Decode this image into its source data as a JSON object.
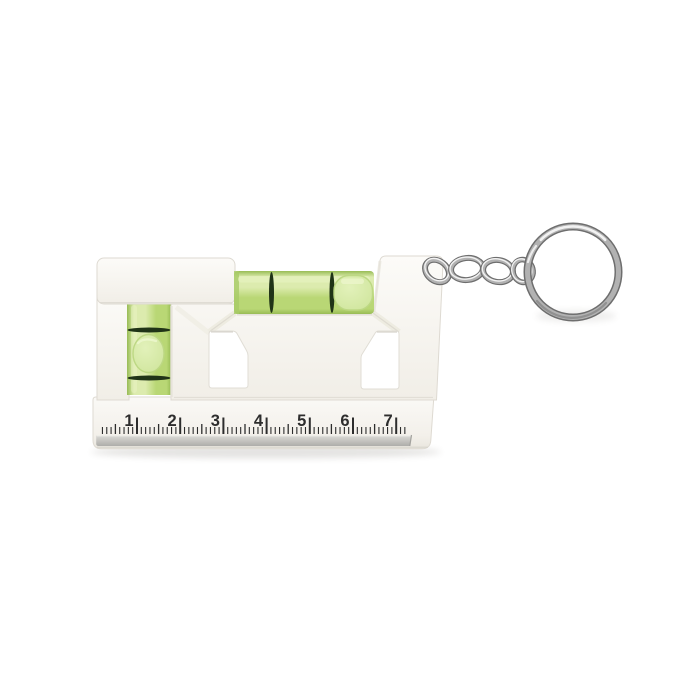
{
  "ruler": {
    "numbers": [
      "1",
      "2",
      "3",
      "4",
      "5",
      "6",
      "7"
    ],
    "minor_ticks_per_unit": 10
  },
  "colors": {
    "background": "#ffffff",
    "body": "#f7f5f0",
    "body_shade": "#e3e0d8",
    "body_edge": "#dedad2",
    "vial_green": "#b9d775",
    "vial_green_light": "#dcebae",
    "vial_green_dark": "#98bc55",
    "vial_ring": "#203417",
    "bubble": "#e2f1ba",
    "ruler_mark": "#2d2d2d",
    "metal_strip": "#c6c5c1",
    "metal_strip_light": "#dddcd8",
    "metal_strip_dark": "#aeadaa",
    "chain_dark": "#6e6e6e",
    "chain_mid": "#b2b2b2",
    "chain_light": "#f2f2f2"
  }
}
